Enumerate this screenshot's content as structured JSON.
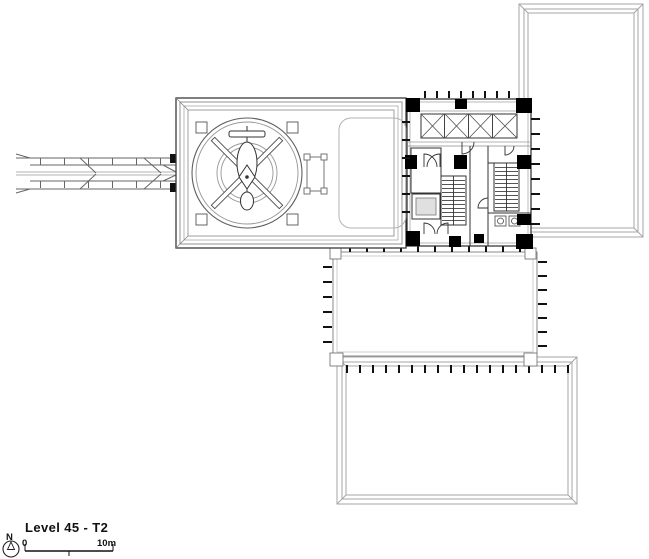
{
  "drawing": {
    "title": "Level 45 - T2",
    "north_label": "N",
    "scale_bar": {
      "start_label": "0",
      "end_label": "10m"
    },
    "colors": {
      "background": "#ffffff",
      "line_dark": "#1a1a1a",
      "line_gray": "#9a9a9a",
      "column_fill": "#000000"
    },
    "icons": {
      "north": "north-compass-icon",
      "helipad": "helipad-circle-icon",
      "helicopter": "helicopter-plan-icon"
    }
  }
}
